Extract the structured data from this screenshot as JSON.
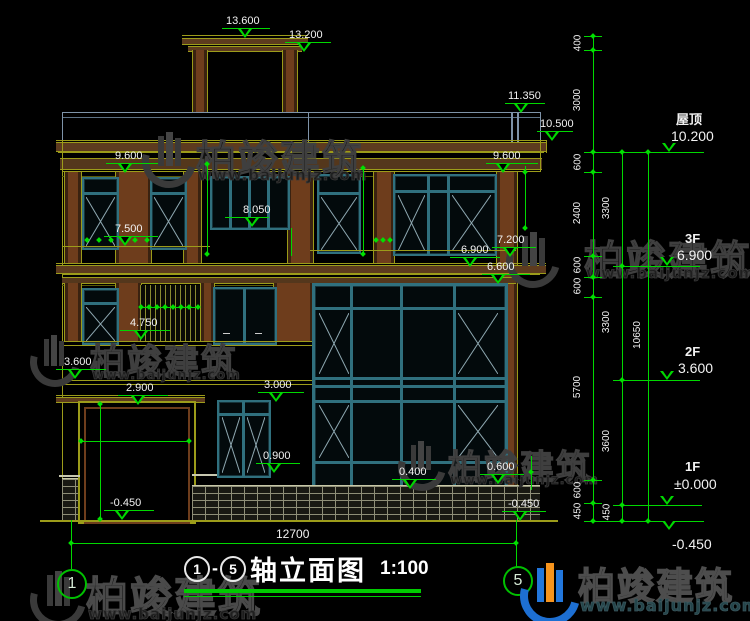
{
  "title_block": {
    "axis_start": "1",
    "dash": "-",
    "axis_end": "5",
    "name": "轴立面图",
    "scale": "1:100"
  },
  "axis_bubbles": {
    "left": "1",
    "right": "5"
  },
  "brand": {
    "name": "柏竣建筑",
    "url": "www.baijunjz.com"
  },
  "floor_markers": {
    "roof_label": "屋顶",
    "roof_elev": "10.200",
    "f3_label": "3F",
    "f3_elev": "6.900",
    "f2_label": "2F",
    "f2_elev": "3.600",
    "f1_label": "1F",
    "f1_elev": "±0.000",
    "ground_elev": "-0.450"
  },
  "levels": {
    "l13600": "13.600",
    "l13200": "13.200",
    "l11350": "11.350",
    "l10500": "10.500",
    "l9600": "9.600",
    "l8050": "8.050",
    "l7500": "7.500",
    "l7200": "7.200",
    "l6900": "6.900",
    "l6600": "6.600",
    "l4750": "4.750",
    "l3600": "3.600",
    "l3000": "3.000",
    "l2900": "2.900",
    "l0900": "0.900",
    "l0600": "0.600",
    "l0400": "0.400",
    "lm0450": "-0.450"
  },
  "chains": {
    "a": [
      "400",
      "3000",
      "600",
      "2400",
      "600",
      "600",
      "5700",
      "600",
      "450"
    ],
    "b": [
      "3300",
      "3300",
      "3600",
      "450"
    ],
    "total_h": "10650",
    "total_w": "12700"
  },
  "colors": {
    "dim_green": "#00d800",
    "line_olive": "#9c9c1a",
    "frame_teal": "#30707e",
    "wood_brown": "#6e3d1c",
    "logo_blue": "#1d6fd2",
    "logo_orange": "#f7941d"
  }
}
